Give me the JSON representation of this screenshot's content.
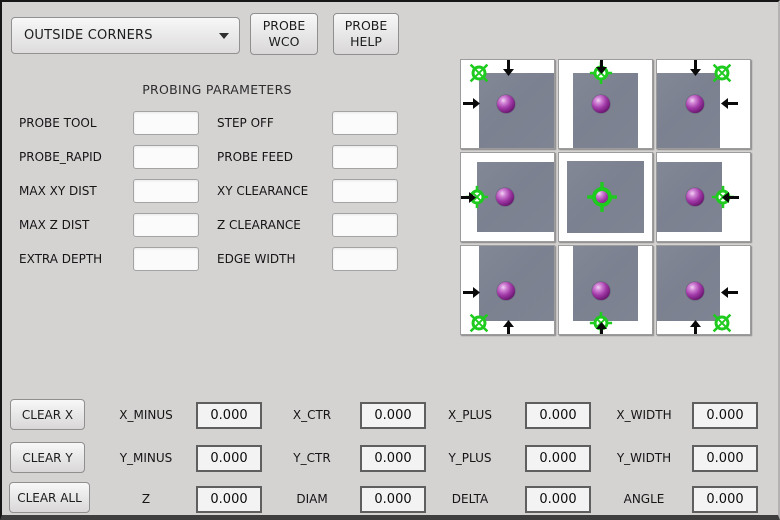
{
  "toolbar": {
    "mode_select": {
      "value": "OUTSIDE CORNERS"
    },
    "probe_wco_button": {
      "line1": "PROBE",
      "line2": "WCO"
    },
    "probe_help_button": {
      "line1": "PROBE",
      "line2": "HELP"
    }
  },
  "parameters": {
    "title": "PROBING PARAMETERS",
    "rows": [
      {
        "left_label": "PROBE TOOL",
        "left_value": "",
        "right_label": "STEP OFF",
        "right_value": ""
      },
      {
        "left_label": "PROBE_RAPID",
        "left_value": "",
        "right_label": "PROBE FEED",
        "right_value": ""
      },
      {
        "left_label": "MAX XY DIST",
        "left_value": "",
        "right_label": "XY CLEARANCE",
        "right_value": ""
      },
      {
        "left_label": "MAX Z DIST",
        "left_value": "",
        "right_label": "Z CLEARANCE",
        "right_value": ""
      },
      {
        "left_label": "EXTRA DEPTH",
        "left_value": "",
        "right_label": "EDGE WIDTH",
        "right_value": ""
      }
    ]
  },
  "results": {
    "clear_x_label": "CLEAR X",
    "clear_y_label": "CLEAR Y",
    "clear_all_label": "CLEAR ALL",
    "rows": [
      {
        "cells": [
          {
            "label": "X_MINUS",
            "value": "0.000"
          },
          {
            "label": "X_CTR",
            "value": "0.000"
          },
          {
            "label": "X_PLUS",
            "value": "0.000"
          },
          {
            "label": "X_WIDTH",
            "value": "0.000"
          }
        ]
      },
      {
        "cells": [
          {
            "label": "Y_MINUS",
            "value": "0.000"
          },
          {
            "label": "Y_CTR",
            "value": "0.000"
          },
          {
            "label": "Y_PLUS",
            "value": "0.000"
          },
          {
            "label": "Y_WIDTH",
            "value": "0.000"
          }
        ]
      },
      {
        "cells": [
          {
            "label": "Z",
            "value": "0.000"
          },
          {
            "label": "DIAM",
            "value": "0.000"
          },
          {
            "label": "DELTA",
            "value": "0.000"
          },
          {
            "label": "ANGLE",
            "value": "0.000"
          }
        ]
      }
    ]
  },
  "probe_image": {
    "colors": {
      "target_green": "#1ecb1e",
      "surface_gray": "#7b8190",
      "arrow_black": "#0a0a0a",
      "sphere_purple": "#a23aa8",
      "tile_white": "#ffffff"
    },
    "tiles": [
      {
        "name": "top-left-corner",
        "x": 0,
        "y": 0,
        "square": [
          13,
          0,
          0,
          18
        ],
        "cross": {
          "x": 18,
          "y": 13,
          "s": 24,
          "variant": "corner"
        },
        "sphere": {
          "x": 45,
          "y": 44
        },
        "arrows": [
          {
            "dir": "down",
            "x": 47,
            "y": 16
          },
          {
            "dir": "right",
            "x": 19,
            "y": 43
          }
        ]
      },
      {
        "name": "top-edge",
        "x": 98,
        "y": 0,
        "square": [
          13,
          14,
          0,
          14
        ],
        "cross": {
          "x": 42,
          "y": 13,
          "s": 24,
          "variant": "edge"
        },
        "sphere": {
          "x": 42,
          "y": 44
        },
        "arrows": [
          {
            "dir": "down",
            "x": 42,
            "y": 14
          }
        ]
      },
      {
        "name": "top-right-corner",
        "x": 196,
        "y": 0,
        "square": [
          13,
          30,
          0,
          0
        ],
        "cross": {
          "x": 65,
          "y": 13,
          "s": 24,
          "variant": "corner"
        },
        "sphere": {
          "x": 38,
          "y": 44
        },
        "arrows": [
          {
            "dir": "down",
            "x": 38,
            "y": 16
          },
          {
            "dir": "left",
            "x": 64,
            "y": 43
          }
        ]
      },
      {
        "name": "left-edge",
        "x": 0,
        "y": 93,
        "square": [
          9,
          0,
          9,
          16
        ],
        "cross": {
          "x": 16,
          "y": 44,
          "s": 24,
          "variant": "edge"
        },
        "sphere": {
          "x": 44,
          "y": 44
        },
        "arrows": [
          {
            "dir": "right",
            "x": 15,
            "y": 44
          }
        ]
      },
      {
        "name": "center",
        "x": 98,
        "y": 93,
        "square": [
          8,
          8,
          8,
          8
        ],
        "cross": {
          "x": 43,
          "y": 44,
          "s": 32,
          "variant": "center"
        },
        "sphere": {
          "x": 43,
          "y": 44
        },
        "arrows": []
      },
      {
        "name": "right-edge",
        "x": 196,
        "y": 93,
        "square": [
          9,
          28,
          9,
          0
        ],
        "cross": {
          "x": 66,
          "y": 44,
          "s": 24,
          "variant": "edge"
        },
        "sphere": {
          "x": 38,
          "y": 44
        },
        "arrows": [
          {
            "dir": "left",
            "x": 65,
            "y": 44
          }
        ]
      },
      {
        "name": "bottom-left-corner",
        "x": 0,
        "y": 186,
        "square": [
          0,
          0,
          13,
          18
        ],
        "cross": {
          "x": 18,
          "y": 77,
          "s": 24,
          "variant": "corner"
        },
        "sphere": {
          "x": 45,
          "y": 45
        },
        "arrows": [
          {
            "dir": "right",
            "x": 19,
            "y": 46
          },
          {
            "dir": "up",
            "x": 47,
            "y": 74
          }
        ]
      },
      {
        "name": "bottom-edge",
        "x": 98,
        "y": 186,
        "square": [
          0,
          14,
          13,
          14
        ],
        "cross": {
          "x": 42,
          "y": 77,
          "s": 24,
          "variant": "edge"
        },
        "sphere": {
          "x": 42,
          "y": 45
        },
        "arrows": [
          {
            "dir": "up",
            "x": 42,
            "y": 76
          }
        ]
      },
      {
        "name": "bottom-right-corner",
        "x": 196,
        "y": 186,
        "square": [
          0,
          30,
          13,
          0
        ],
        "cross": {
          "x": 65,
          "y": 77,
          "s": 24,
          "variant": "corner"
        },
        "sphere": {
          "x": 38,
          "y": 45
        },
        "arrows": [
          {
            "dir": "left",
            "x": 64,
            "y": 46
          },
          {
            "dir": "up",
            "x": 38,
            "y": 74
          }
        ]
      }
    ]
  }
}
